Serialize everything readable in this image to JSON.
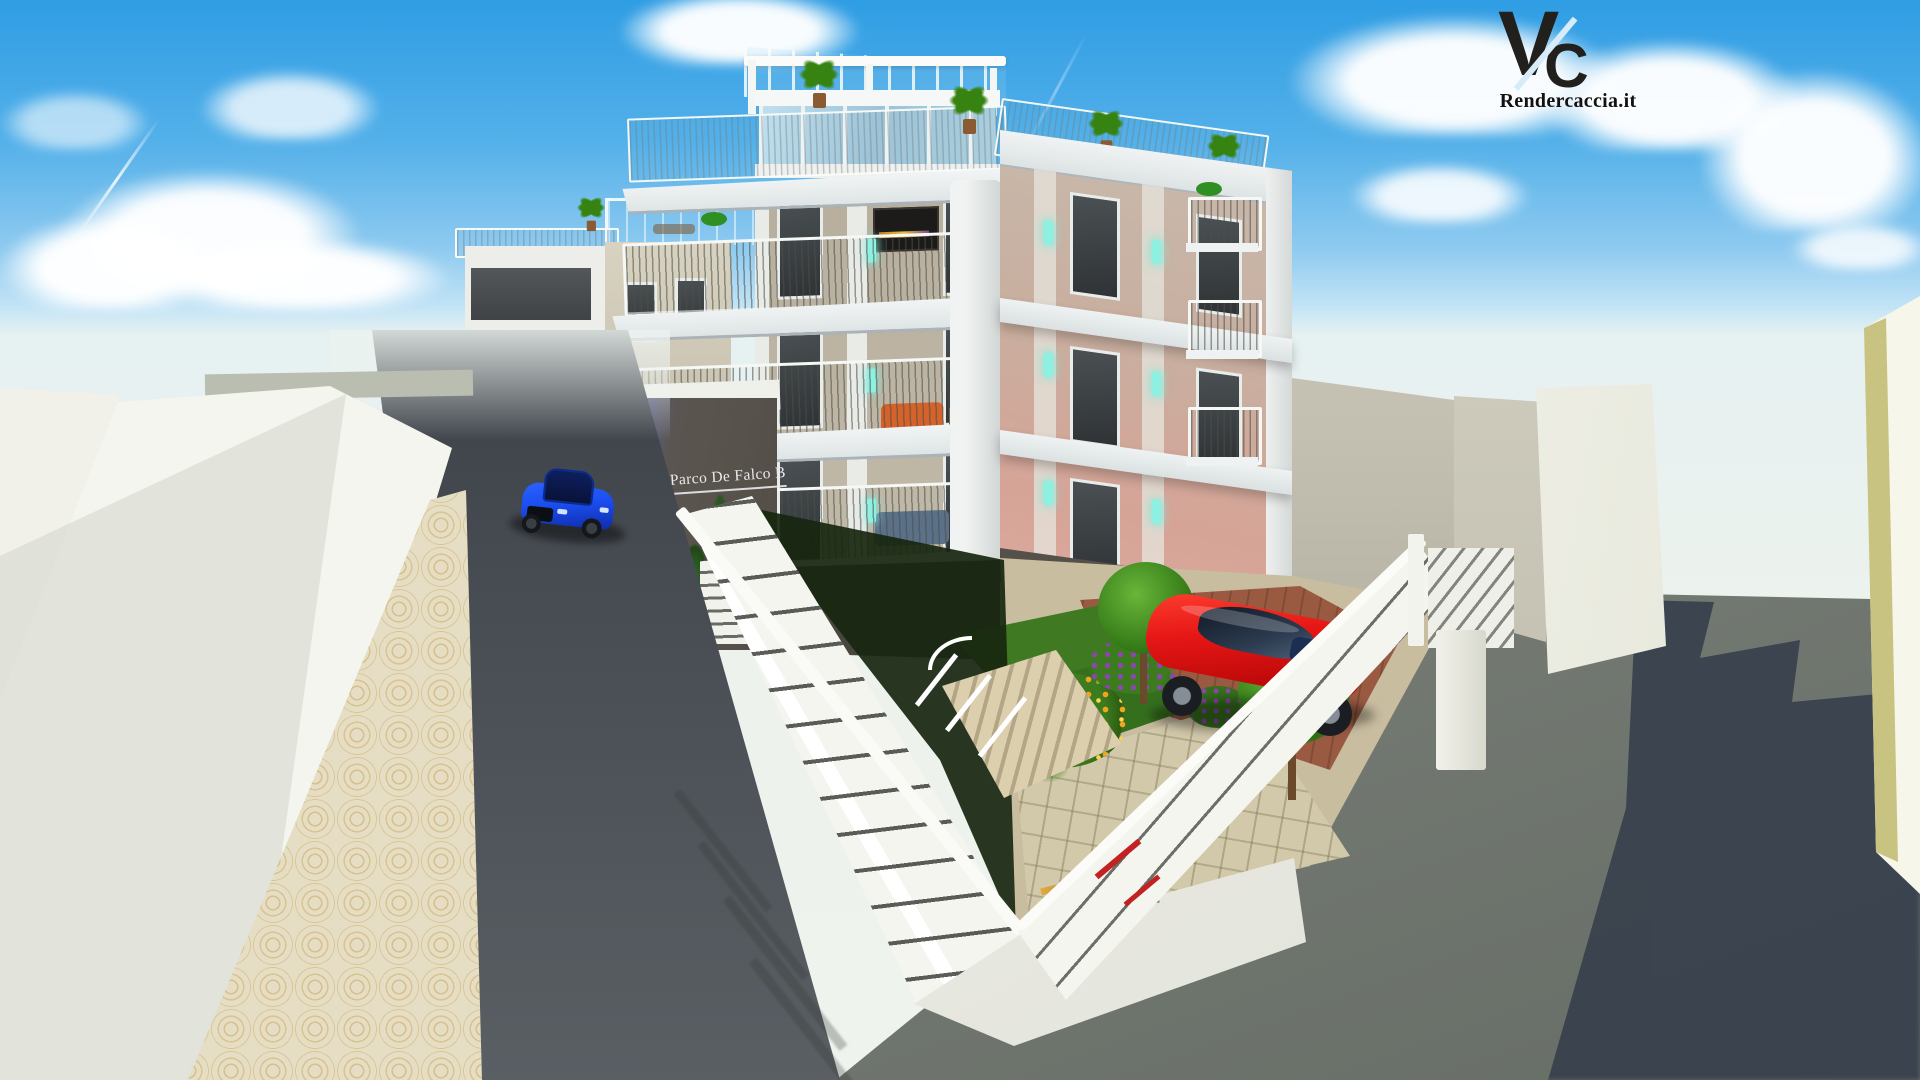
{
  "meta": {
    "width": 1920,
    "height": 1080,
    "kind": "3D architectural exterior rendering",
    "subject": "Modern four-storey residential building with roof terrace pergola, balconies, fenced courtyard garden, red sports car in the yard and blue sports car on the street"
  },
  "watermark": {
    "letter_v": "V",
    "letter_c": "C",
    "website": "Rendercaccia.it"
  },
  "building_sign": {
    "text": "Parco De Falco B"
  },
  "objects": [
    "sky",
    "clouds",
    "contrail",
    "background-apartment-building",
    "main-apartment-building",
    "roof-pergola",
    "roof-terrace-palms",
    "balcony-railings",
    "teal-wall-sconces",
    "entrance-sign-wall",
    "street",
    "blue-sports-car",
    "white-boundary-walls",
    "cobblestone-sidewalk",
    "courtyard-garden",
    "flower-bushes",
    "small-trees",
    "red-sports-car",
    "white-perimeter-fence",
    "gate",
    "gray-pavement",
    "cast-shadow",
    "watermark-logo"
  ],
  "palette": {
    "sky_top": "#2f9de4",
    "haze": "#edf2ec",
    "cloud": "#ffffff",
    "wall_white": "#f5f5ef",
    "cap_gray": "#b9beb0",
    "street": "#41464d",
    "cobble": "#e5dec5",
    "cobble_arc": "#d3ae62",
    "ground": "#848a81",
    "shadow": "#38414d",
    "slab": "#eef2f3",
    "beige": "#b7ae9d",
    "beige_light": "#d8d2c1",
    "warm": "#d6a497",
    "pillar": "#f1f3f2",
    "window": "#34383a",
    "glass": "#9cc3d8",
    "annex": "#57524b",
    "annex_tint": "#5d5f86",
    "sign_text": "#e9e9eb",
    "fence": "#f5f5f0",
    "fence_slot": "#2d302a",
    "grass": "#3f7a22",
    "hedge": "#17260f",
    "garden_stone": "#d2c8aa",
    "brick": "#9a5a42",
    "tree": "#378312",
    "flower_orange": "#f0a51d",
    "flower_purple": "#8d45b0",
    "car_blue": "#1b4ef0",
    "car_red": "#e51616",
    "flame": "#ff8c1a",
    "sconce": "#8df0e0",
    "logo_ink": "#22201d",
    "boundary": "#c3c0b2",
    "yellow_wall": "#c9c382"
  }
}
